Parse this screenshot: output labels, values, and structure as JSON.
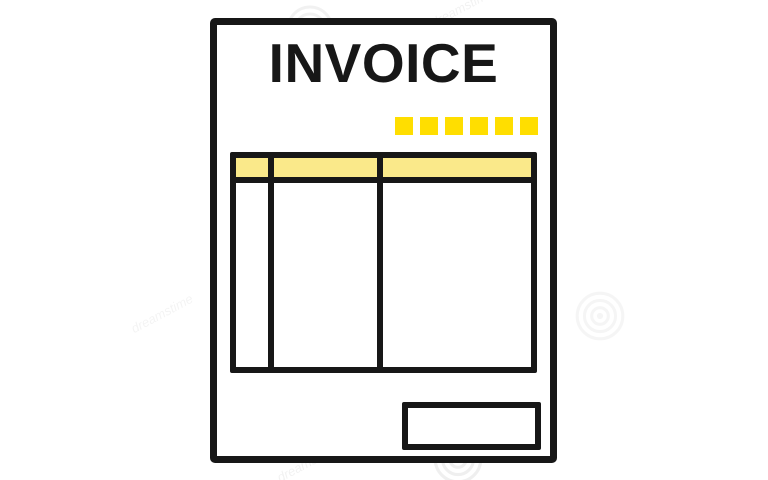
{
  "page": {
    "background_color": "#ffffff"
  },
  "invoice": {
    "title": "INVOICE",
    "colors": {
      "line": "#171717",
      "accent_yellow": "#ffde00",
      "header_yellow": "#fae98a",
      "paper": "#ffffff"
    },
    "decor_squares": {
      "count": 6,
      "color": "#ffde00"
    },
    "table": {
      "column_count": 3,
      "header_row": {
        "filled": true,
        "cells": [
          "",
          "",
          ""
        ]
      },
      "body_row": {
        "cells": [
          "",
          "",
          ""
        ]
      }
    },
    "total_box": {
      "value": ""
    }
  },
  "watermark": {
    "text": "dreamstime",
    "spiral_count": 5
  }
}
